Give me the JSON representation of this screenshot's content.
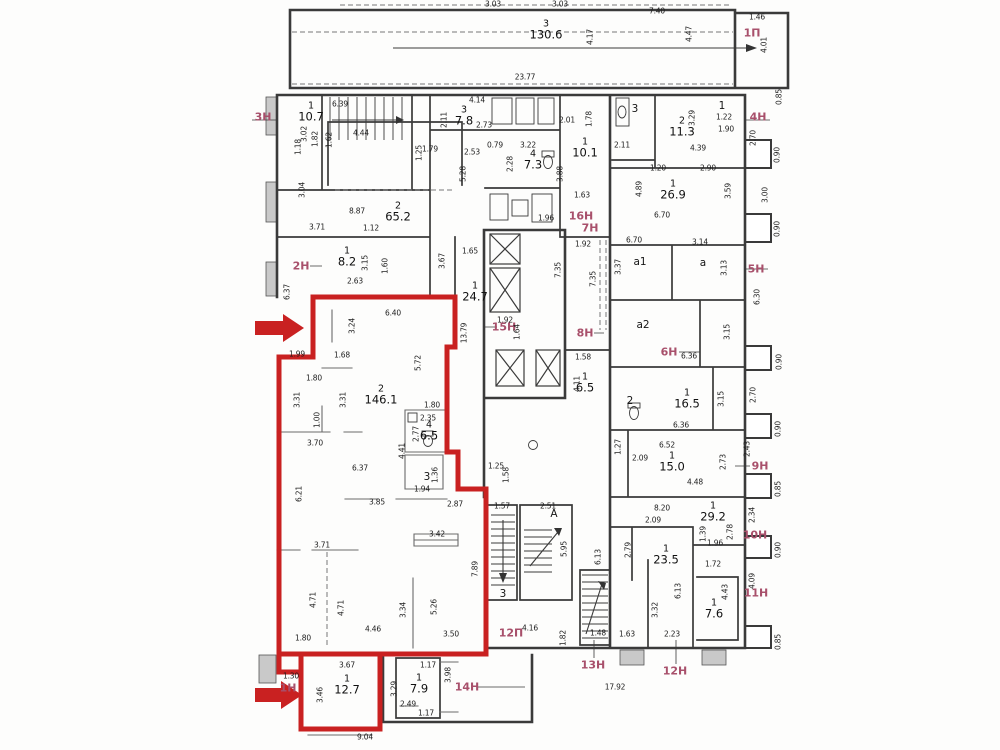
{
  "title": "floor-plan",
  "colors": {
    "outline_red": "#c92121",
    "unit_label": "#a8506b",
    "wall": "#3a3a3a",
    "partition": "#6a6a6a",
    "dim_text": "#1d1d1d",
    "hatch_fill": "#c9c9c9"
  },
  "rooms": [
    {
      "n": "3",
      "a": "130.6",
      "x": 546,
      "y": 30
    },
    {
      "n": "1",
      "a": "10.7",
      "x": 311,
      "y": 112
    },
    {
      "n": "2",
      "a": "65.2",
      "x": 398,
      "y": 212
    },
    {
      "n": "1",
      "a": "8.2",
      "x": 347,
      "y": 257
    },
    {
      "n": "3",
      "a": "7.8",
      "x": 464,
      "y": 116
    },
    {
      "n": "4",
      "a": "7.3",
      "x": 533,
      "y": 160
    },
    {
      "n": "1",
      "a": "10.1",
      "x": 585,
      "y": 148
    },
    {
      "n": "2",
      "a": "11.3",
      "x": 682,
      "y": 127
    },
    {
      "n": "1",
      "a": "26.9",
      "x": 673,
      "y": 190
    },
    {
      "n": "1",
      "a": "24.7",
      "x": 475,
      "y": 292
    },
    {
      "n": "2",
      "a": "146.1",
      "x": 381,
      "y": 395
    },
    {
      "n": "4",
      "a": "6.5",
      "x": 429,
      "y": 431
    },
    {
      "n": "1",
      "a": "6.5",
      "x": 585,
      "y": 383
    },
    {
      "n": "1",
      "a": "16.5",
      "x": 687,
      "y": 399
    },
    {
      "n": "1",
      "a": "15.0",
      "x": 672,
      "y": 462
    },
    {
      "n": "1",
      "a": "29.2",
      "x": 713,
      "y": 512
    },
    {
      "n": "1",
      "a": "23.5",
      "x": 666,
      "y": 555
    },
    {
      "n": "1",
      "a": "7.6",
      "x": 714,
      "y": 609
    },
    {
      "n": "1",
      "a": "12.7",
      "x": 347,
      "y": 685
    },
    {
      "n": "1",
      "a": "7.9",
      "x": 419,
      "y": 684
    }
  ],
  "letters": [
    {
      "t": "а1",
      "x": 640,
      "y": 262
    },
    {
      "t": "а",
      "x": 703,
      "y": 263
    },
    {
      "t": "а2",
      "x": 643,
      "y": 325
    },
    {
      "t": "А",
      "x": 554,
      "y": 514
    },
    {
      "t": "3",
      "x": 503,
      "y": 594
    },
    {
      "t": "3",
      "x": 635,
      "y": 109
    },
    {
      "t": "1",
      "x": 722,
      "y": 106
    },
    {
      "t": "3",
      "x": 427,
      "y": 477
    },
    {
      "t": "2",
      "x": 630,
      "y": 401
    }
  ],
  "unit_labels": [
    {
      "t": "1П",
      "x": 752,
      "y": 33
    },
    {
      "t": "3Н",
      "x": 263,
      "y": 117
    },
    {
      "t": "2Н",
      "x": 301,
      "y": 266
    },
    {
      "t": "4Н",
      "x": 758,
      "y": 117
    },
    {
      "t": "5Н",
      "x": 756,
      "y": 269
    },
    {
      "t": "6Н",
      "x": 669,
      "y": 352
    },
    {
      "t": "16Н",
      "x": 581,
      "y": 216
    },
    {
      "t": "7Н",
      "x": 590,
      "y": 228
    },
    {
      "t": "15Н",
      "x": 504,
      "y": 327
    },
    {
      "t": "8Н",
      "x": 585,
      "y": 333
    },
    {
      "t": "9Н",
      "x": 760,
      "y": 466
    },
    {
      "t": "10Н",
      "x": 755,
      "y": 535
    },
    {
      "t": "11Н",
      "x": 756,
      "y": 593
    },
    {
      "t": "12П",
      "x": 511,
      "y": 633
    },
    {
      "t": "13Н",
      "x": 593,
      "y": 665
    },
    {
      "t": "12Н",
      "x": 675,
      "y": 671
    },
    {
      "t": "14Н",
      "x": 467,
      "y": 687
    },
    {
      "t": "1Н",
      "x": 288,
      "y": 688
    }
  ],
  "dims": [
    [
      "3.03",
      493,
      4,
      0
    ],
    [
      "3.03",
      560,
      4,
      0
    ],
    [
      "7.40",
      657,
      11,
      0
    ],
    [
      "1.46",
      757,
      17,
      0
    ],
    [
      "4.01",
      764,
      45,
      1
    ],
    [
      "4.17",
      590,
      37,
      1
    ],
    [
      "4.47",
      689,
      34,
      1
    ],
    [
      "23.77",
      525,
      77,
      0
    ],
    [
      "0.85",
      779,
      97,
      1
    ],
    [
      "6.39",
      340,
      104,
      0
    ],
    [
      "4.14",
      477,
      100,
      0
    ],
    [
      "3.02",
      304,
      134,
      1
    ],
    [
      "1.82",
      315,
      139,
      1
    ],
    [
      "1.62",
      329,
      140,
      1
    ],
    [
      "1.18",
      298,
      147,
      1
    ],
    [
      "4.44",
      361,
      133,
      0
    ],
    [
      "1.79",
      430,
      149,
      0
    ],
    [
      "1.25",
      419,
      153,
      1
    ],
    [
      "3.04",
      302,
      190,
      1
    ],
    [
      "8.87",
      357,
      211,
      0
    ],
    [
      "3.71",
      317,
      227,
      0
    ],
    [
      "1.12",
      371,
      228,
      0
    ],
    [
      "6.37",
      287,
      292,
      1
    ],
    [
      "2.11",
      444,
      120,
      1
    ],
    [
      "2.73",
      484,
      125,
      0
    ],
    [
      "2.53",
      472,
      152,
      0
    ],
    [
      "0.79",
      495,
      145,
      0
    ],
    [
      "3.22",
      528,
      145,
      0
    ],
    [
      "2.28",
      510,
      164,
      1
    ],
    [
      "5.28",
      463,
      174,
      1
    ],
    [
      "3.88",
      560,
      174,
      1
    ],
    [
      "2.01",
      567,
      120,
      0
    ],
    [
      "1.78",
      589,
      119,
      1
    ],
    [
      "1.63",
      582,
      195,
      0
    ],
    [
      "1.96",
      546,
      218,
      0
    ],
    [
      "1.92",
      583,
      244,
      0
    ],
    [
      "2.11",
      622,
      145,
      0
    ],
    [
      "3.29",
      692,
      118,
      1
    ],
    [
      "1.22",
      724,
      117,
      0
    ],
    [
      "1.90",
      726,
      129,
      0
    ],
    [
      "4.39",
      698,
      148,
      0
    ],
    [
      "1.20",
      658,
      168,
      0
    ],
    [
      "2.90",
      708,
      168,
      0
    ],
    [
      "2.70",
      753,
      138,
      1
    ],
    [
      "0.90",
      777,
      155,
      1
    ],
    [
      "4.89",
      639,
      189,
      1
    ],
    [
      "3.59",
      728,
      191,
      1
    ],
    [
      "3.00",
      765,
      195,
      1
    ],
    [
      "6.70",
      662,
      215,
      0
    ],
    [
      "0.90",
      777,
      229,
      1
    ],
    [
      "6.70",
      634,
      240,
      0
    ],
    [
      "3.14",
      700,
      242,
      0
    ],
    [
      "3.15",
      365,
      263,
      1
    ],
    [
      "1.60",
      385,
      266,
      1
    ],
    [
      "2.63",
      355,
      281,
      0
    ],
    [
      "3.67",
      442,
      261,
      1
    ],
    [
      "1.65",
      470,
      251,
      0
    ],
    [
      "3.37",
      618,
      267,
      1
    ],
    [
      "3.13",
      724,
      268,
      1
    ],
    [
      "6.30",
      757,
      297,
      1
    ],
    [
      "3.15",
      727,
      332,
      1
    ],
    [
      "6.36",
      689,
      356,
      0
    ],
    [
      "0.90",
      779,
      362,
      1
    ],
    [
      "7.35",
      558,
      270,
      1
    ],
    [
      "7.35",
      593,
      279,
      1
    ],
    [
      "1.92",
      505,
      320,
      0
    ],
    [
      "1.64",
      517,
      332,
      1
    ],
    [
      "13.79",
      464,
      333,
      1
    ],
    [
      "1.58",
      583,
      357,
      0
    ],
    [
      "4.11",
      577,
      384,
      1
    ],
    [
      "6.40",
      393,
      313,
      0
    ],
    [
      "3.24",
      352,
      326,
      1
    ],
    [
      "1.99",
      297,
      354,
      0
    ],
    [
      "1.68",
      342,
      355,
      0
    ],
    [
      "5.72",
      418,
      363,
      1
    ],
    [
      "1.80",
      314,
      378,
      0
    ],
    [
      "3.31",
      297,
      400,
      1
    ],
    [
      "3.31",
      343,
      400,
      1
    ],
    [
      "1.80",
      432,
      405,
      0
    ],
    [
      "2.35",
      428,
      418,
      0
    ],
    [
      "1.00",
      317,
      420,
      1
    ],
    [
      "2.77",
      416,
      434,
      1
    ],
    [
      "3.70",
      315,
      443,
      0
    ],
    [
      "4.41",
      402,
      451,
      1
    ],
    [
      "6.37",
      360,
      468,
      0
    ],
    [
      "1.36",
      435,
      475,
      1
    ],
    [
      "1.94",
      422,
      489,
      0
    ],
    [
      "6.21",
      299,
      494,
      1
    ],
    [
      "3.85",
      377,
      502,
      0
    ],
    [
      "2.87",
      455,
      504,
      0
    ],
    [
      "1.25",
      496,
      466,
      0
    ],
    [
      "1.58",
      506,
      475,
      1
    ],
    [
      "3.15",
      721,
      399,
      1
    ],
    [
      "2.70",
      753,
      395,
      1
    ],
    [
      "6.36",
      681,
      425,
      0
    ],
    [
      "0.90",
      778,
      429,
      1
    ],
    [
      "1.27",
      618,
      447,
      1
    ],
    [
      "6.52",
      667,
      445,
      0
    ],
    [
      "2.09",
      640,
      458,
      0
    ],
    [
      "2.73",
      723,
      462,
      1
    ],
    [
      "2.43",
      747,
      449,
      1
    ],
    [
      "4.48",
      695,
      482,
      0
    ],
    [
      "0.85",
      778,
      489,
      1
    ],
    [
      "1.57",
      502,
      506,
      0
    ],
    [
      "2.51",
      548,
      506,
      0
    ],
    [
      "5.95",
      564,
      549,
      1
    ],
    [
      "6.13",
      598,
      557,
      1
    ],
    [
      "4.16",
      530,
      628,
      0
    ],
    [
      "1.82",
      563,
      638,
      1
    ],
    [
      "8.20",
      662,
      508,
      0
    ],
    [
      "2.09",
      653,
      520,
      0
    ],
    [
      "1.39",
      703,
      534,
      1
    ],
    [
      "2.78",
      730,
      532,
      1
    ],
    [
      "2.34",
      752,
      515,
      1
    ],
    [
      "1.96",
      715,
      543,
      0
    ],
    [
      "0.90",
      778,
      550,
      1
    ],
    [
      "2.79",
      628,
      550,
      1
    ],
    [
      "1.72",
      713,
      564,
      0
    ],
    [
      "6.13",
      678,
      591,
      1
    ],
    [
      "4.43",
      725,
      592,
      1
    ],
    [
      "4.09",
      752,
      581,
      1
    ],
    [
      "3.32",
      655,
      610,
      1
    ],
    [
      "2.23",
      672,
      634,
      0
    ],
    [
      "1.63",
      627,
      634,
      0
    ],
    [
      "1.48",
      598,
      633,
      0
    ],
    [
      "0.85",
      778,
      642,
      1
    ],
    [
      "17.92",
      615,
      687,
      0
    ],
    [
      "3.42",
      437,
      534,
      0
    ],
    [
      "3.71",
      322,
      545,
      0
    ],
    [
      "7.89",
      475,
      569,
      1
    ],
    [
      "4.71",
      313,
      600,
      1
    ],
    [
      "4.71",
      341,
      608,
      1
    ],
    [
      "3.34",
      403,
      610,
      1
    ],
    [
      "5.26",
      434,
      607,
      1
    ],
    [
      "4.46",
      373,
      629,
      0
    ],
    [
      "3.50",
      451,
      634,
      0
    ],
    [
      "1.80",
      303,
      638,
      0
    ],
    [
      "3.67",
      347,
      665,
      0
    ],
    [
      "1.30",
      291,
      676,
      0
    ],
    [
      "3.46",
      320,
      695,
      1
    ],
    [
      "3.29",
      394,
      689,
      1
    ],
    [
      "1.17",
      428,
      665,
      0
    ],
    [
      "3.98",
      448,
      675,
      1
    ],
    [
      "2.49",
      408,
      704,
      0
    ],
    [
      "1.17",
      426,
      713,
      0
    ],
    [
      "9.04",
      365,
      737,
      0
    ]
  ]
}
